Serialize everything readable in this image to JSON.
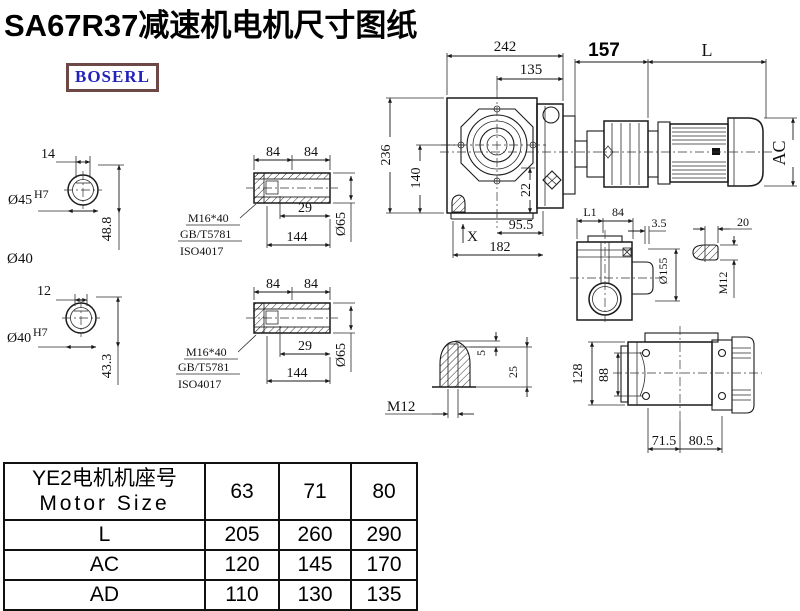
{
  "title": "SA67R37减速机电机尺寸图纸",
  "logo": "BOSERL",
  "dims": {
    "shaft1": {
      "keyway": "14",
      "bore": "Ø45",
      "fit": "H7",
      "depth": "48.8",
      "outer": "Ø40"
    },
    "shaft2": {
      "keyway": "12",
      "bore": "Ø40",
      "fit": "H7",
      "depth": "43.3"
    },
    "sleeve1": {
      "seg1": "84",
      "seg2": "84",
      "inset": "29",
      "length": "144",
      "dia": "Ø65",
      "bolt": "M16*40",
      "std1": "GB/T5781",
      "std2": "ISO4017"
    },
    "sleeve2": {
      "seg1": "84",
      "seg2": "84",
      "inset": "29",
      "length": "144",
      "dia": "Ø65",
      "bolt": "M16*40",
      "std1": "GB/T5781",
      "std2": "ISO4017"
    },
    "main": {
      "total_width": "242",
      "center_to_face": "135",
      "adapter_len": "157",
      "motor_len": "L",
      "total_height": "236",
      "center_height": "140",
      "base_offset": "22",
      "center_offset": "95.5",
      "detail_mark": "X",
      "base_width": "182",
      "motor_dia": "AC"
    },
    "side": {
      "seg1": "L1",
      "seg2": "84",
      "lip": "3.5",
      "flange_dia": "Ø155"
    },
    "stud": {
      "length": "20",
      "thread": "M12"
    },
    "detail_x": {
      "tip": "5",
      "depth": "25",
      "thread": "M12"
    },
    "bottom": {
      "height": "128",
      "bolt_span": "88",
      "left": "71.5",
      "right": "80.5"
    }
  },
  "table": {
    "header": {
      "cn": "YE2电机机座号",
      "en": "Motor Size"
    },
    "columns": [
      "63",
      "71",
      "80"
    ],
    "rows": [
      {
        "label": "L",
        "values": [
          "205",
          "260",
          "290"
        ]
      },
      {
        "label": "AC",
        "values": [
          "120",
          "145",
          "170"
        ]
      },
      {
        "label": "AD",
        "values": [
          "110",
          "130",
          "135"
        ]
      }
    ]
  }
}
